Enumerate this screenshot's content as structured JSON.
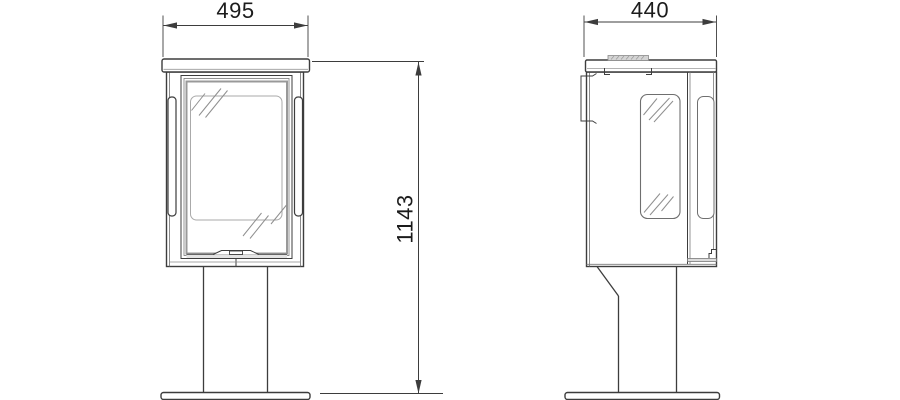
{
  "drawing": {
    "type": "technical line drawing",
    "views": {
      "front": "front elevation",
      "side": "side elevation"
    },
    "dimensions": {
      "width": {
        "value": "495",
        "view": "front",
        "orientation": "horizontal"
      },
      "depth": {
        "value": "440",
        "view": "side",
        "orientation": "horizontal"
      },
      "height": {
        "value": "1143",
        "view": "front",
        "orientation": "vertical"
      }
    },
    "colors": {
      "background": "#ffffff",
      "line": "#3d3d3d",
      "detail_line": "#8f8f8f",
      "text": "#1c1c1c"
    }
  }
}
